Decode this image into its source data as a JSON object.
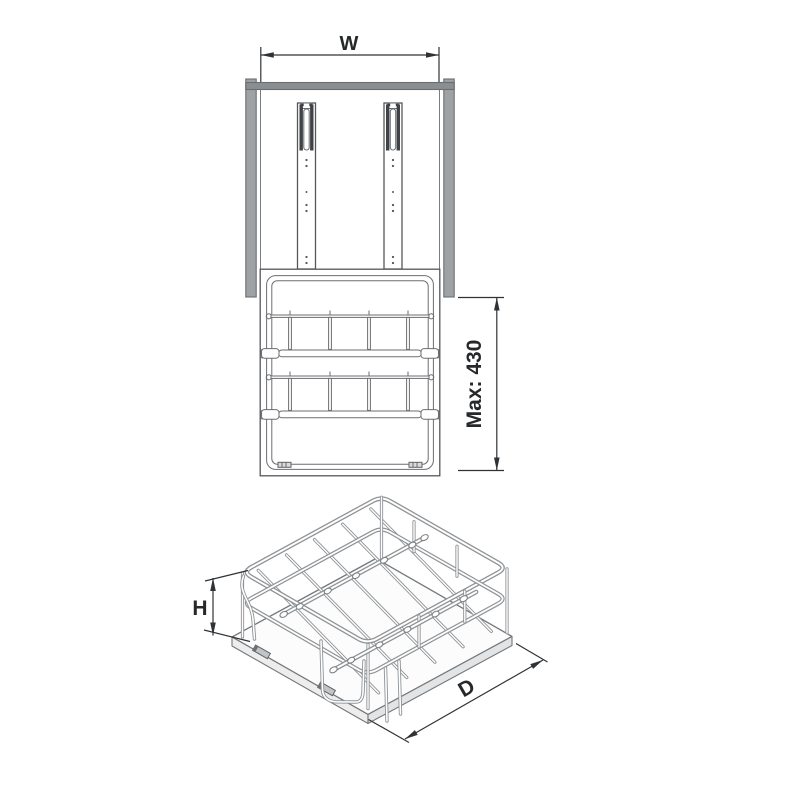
{
  "labels": {
    "width": "W",
    "max_height": "Max: 430",
    "height": "H",
    "depth": "D"
  },
  "colors": {
    "line": "#54575b",
    "dimension_text": "#26282a",
    "cabinet_side_gray": "#9fa2a4",
    "cabinet_top_gray": "#8b8e90",
    "wire_tube_gray": "#8f9396",
    "background": "#ffffff"
  }
}
